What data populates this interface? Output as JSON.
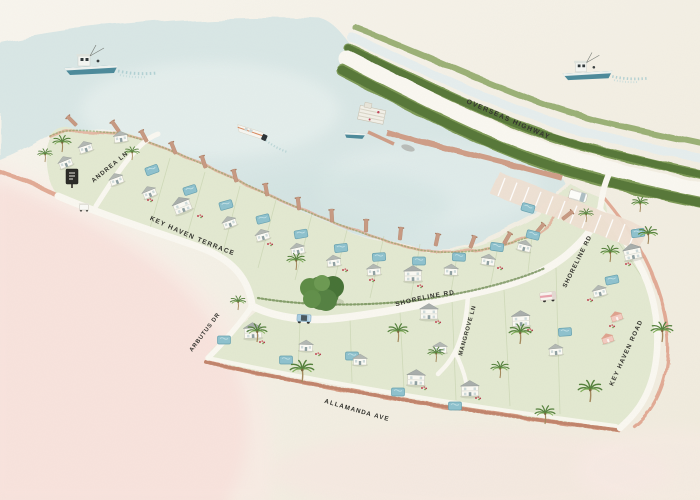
{
  "map": {
    "type": "illustrated-community-site-map",
    "road_labels": {
      "andrea_ln": "ANDREA LN",
      "key_haven_terrace": "KEY HAVEN TERRACE",
      "shoreline_rd_west": "SHORELINE RD",
      "shoreline_rd_east": "SHORELINE RD",
      "mangrove_ln": "MANGROVE LN",
      "arbutus_dr": "ARBUTUS DR",
      "allamanda_ave": "ALLAMANDA AVE",
      "key_haven_road": "KEY HAVEN ROAD",
      "overseas_highway": "OVERSEAS HIGHWAY"
    },
    "palette": {
      "paper": "#f3efe4",
      "water": "#d9e7e6",
      "water_light": "#e9f1ef",
      "land_green": "#e3e9d1",
      "vegetation": "#6d8a49",
      "vegetation_dark": "#4f6f33",
      "road_white": "#faf8f1",
      "shore_pink": "#e2ab96",
      "beach_pink": "#f5d7d0",
      "pier_tan": "#cf9e88",
      "pool_teal": "#8fc2ce",
      "house_white": "#fbfaf5",
      "house_pink": "#f3cbc1",
      "roof_gray": "#acb1b0",
      "label_ink": "#33332e",
      "boat_teal": "#4d8b9b"
    },
    "features": {
      "boats": [
        "fishing-boat-northwest",
        "speedboat-center",
        "fishing-boat-northeast",
        "docked-boat-marina"
      ],
      "vehicles": [
        "white-van-parking",
        "blue-jeep-shoreline",
        "pink-truck-shoreline",
        "golf-cart-entrance"
      ],
      "landmarks": [
        "entrance-sign",
        "marina-dock",
        "boat-pier",
        "parking-lot",
        "banyan-tree"
      ]
    },
    "stamps": [
      {
        "symbol": "sym-dock",
        "name": "dock",
        "layer": "docks",
        "interactable": "false",
        "items": [
          [
            118,
            130,
            -125
          ],
          [
            146,
            140,
            -118
          ],
          [
            175,
            152,
            -112
          ],
          [
            205,
            166,
            -108
          ],
          [
            236,
            180,
            -104
          ],
          [
            267,
            194,
            -100
          ],
          [
            299,
            208,
            -97
          ],
          [
            332,
            220,
            -93
          ],
          [
            366,
            230,
            -89
          ],
          [
            400,
            238,
            -84
          ],
          [
            436,
            244,
            -78
          ],
          [
            471,
            246,
            -70
          ],
          [
            505,
            242,
            -60
          ],
          [
            537,
            232,
            -50
          ],
          [
            564,
            218,
            -38
          ],
          [
            75,
            124,
            -135
          ]
        ]
      },
      {
        "symbol": "sym-pool",
        "name": "swimming-pool",
        "layer": "pools",
        "interactable": "false",
        "items": [
          [
            152,
            170,
            -20
          ],
          [
            190,
            190,
            -18
          ],
          [
            226,
            205,
            -16
          ],
          [
            263,
            219,
            -14
          ],
          [
            301,
            234,
            -10
          ],
          [
            341,
            248,
            -7
          ],
          [
            379,
            257,
            -4
          ],
          [
            419,
            261,
            0
          ],
          [
            459,
            257,
            3
          ],
          [
            497,
            247,
            8
          ],
          [
            533,
            235,
            14
          ],
          [
            638,
            233,
            -8
          ],
          [
            612,
            280,
            -12
          ],
          [
            224,
            340,
            0
          ],
          [
            286,
            360,
            0
          ],
          [
            352,
            356,
            0
          ],
          [
            398,
            392,
            0
          ],
          [
            455,
            406,
            0
          ],
          [
            565,
            332,
            -4
          ],
          [
            528,
            208,
            16
          ]
        ]
      },
      {
        "symbol": "sym-flowers",
        "name": "flower-bed",
        "layer": "flowers",
        "interactable": "false",
        "items": [
          [
            200,
            216,
            0
          ],
          [
            270,
            244,
            0
          ],
          [
            345,
            270,
            0
          ],
          [
            420,
            286,
            0
          ],
          [
            500,
            268,
            0
          ],
          [
            590,
            300,
            0
          ],
          [
            628,
            264,
            0
          ],
          [
            262,
            342,
            0
          ],
          [
            318,
            354,
            0
          ],
          [
            438,
            322,
            0
          ],
          [
            530,
            330,
            0
          ],
          [
            478,
            398,
            0
          ],
          [
            424,
            388,
            0
          ],
          [
            612,
            326,
            0
          ],
          [
            372,
            280,
            0
          ],
          [
            150,
            200,
            0
          ]
        ]
      },
      {
        "symbol": "sym-house-sm",
        "name": "house",
        "layer": "houses",
        "interactable": "true",
        "items": [
          [
            86,
            149,
            -18
          ],
          [
            121,
            139,
            -8
          ],
          [
            66,
            164,
            -22
          ],
          [
            117,
            181,
            -20
          ],
          [
            150,
            194,
            -22
          ],
          [
            230,
            224,
            -20
          ],
          [
            263,
            237,
            -16
          ],
          [
            298,
            251,
            -12
          ],
          [
            334,
            263,
            -8
          ],
          [
            374,
            272,
            -5
          ],
          [
            451,
            272,
            3
          ],
          [
            488,
            262,
            8
          ],
          [
            524,
            248,
            14
          ],
          [
            600,
            293,
            -14
          ],
          [
            306,
            348,
            2
          ],
          [
            360,
            362,
            0
          ],
          [
            440,
            350,
            0
          ],
          [
            556,
            352,
            -5
          ]
        ]
      },
      {
        "symbol": "sym-house-lg",
        "name": "house-two-story",
        "layer": "houses",
        "interactable": "true",
        "items": [
          [
            183,
            208,
            -22
          ],
          [
            413,
            277,
            -1
          ],
          [
            633,
            255,
            -12
          ],
          [
            253,
            334,
            -3
          ],
          [
            429,
            315,
            0
          ],
          [
            521,
            322,
            -3
          ],
          [
            470,
            392,
            -1
          ],
          [
            416,
            381,
            2
          ]
        ]
      },
      {
        "symbol": "sym-house-pink",
        "name": "house-pink",
        "layer": "houses",
        "interactable": "true",
        "items": [
          [
            617,
            318,
            -18
          ],
          [
            608,
            340,
            -18
          ]
        ]
      },
      {
        "symbol": "sym-palm",
        "name": "palm-tree",
        "layer": "palms",
        "interactable": "false",
        "items": [
          [
            62,
            152,
            0,
            1
          ],
          [
            45,
            162,
            0,
            0.8
          ],
          [
            296,
            270,
            0,
            1
          ],
          [
            257,
            342,
            0,
            1.1
          ],
          [
            302,
            382,
            0,
            1.3
          ],
          [
            398,
            342,
            0,
            1.1
          ],
          [
            436,
            362,
            0,
            0.9
          ],
          [
            520,
            344,
            0,
            1.2
          ],
          [
            610,
            262,
            0,
            1
          ],
          [
            648,
            244,
            0,
            1.05
          ],
          [
            662,
            342,
            0,
            1.2
          ],
          [
            590,
            402,
            0,
            1.3
          ],
          [
            545,
            424,
            0,
            1.1
          ],
          [
            640,
            212,
            0,
            0.9
          ],
          [
            238,
            310,
            0,
            0.85
          ],
          [
            500,
            378,
            0,
            1
          ],
          [
            586,
            222,
            0,
            0.8
          ],
          [
            132,
            160,
            0,
            0.8
          ]
        ]
      }
    ]
  }
}
